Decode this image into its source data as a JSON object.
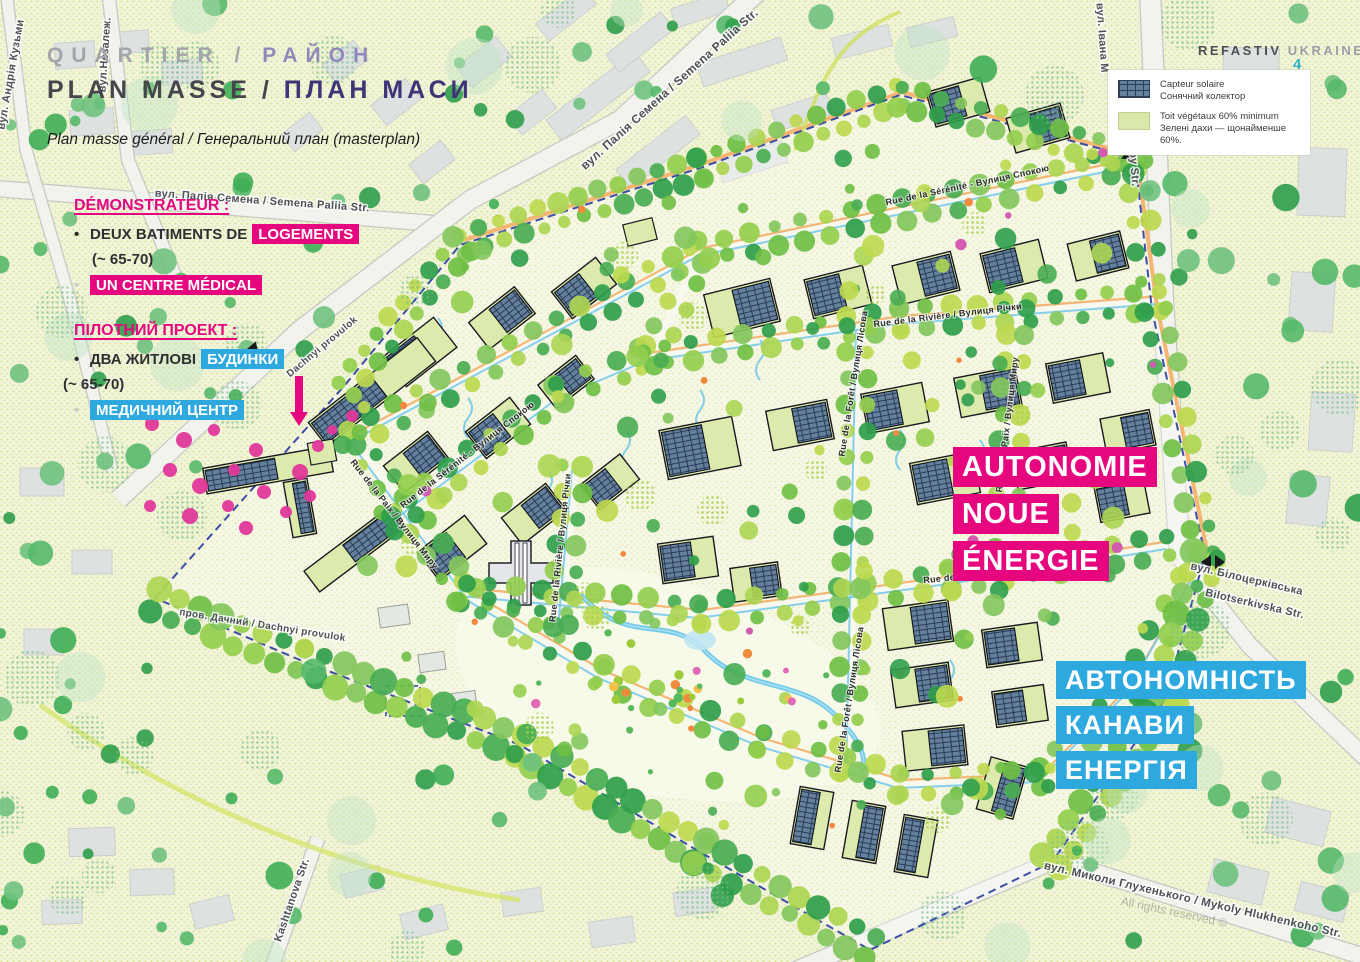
{
  "header": {
    "kicker_fr": "QUARTIER",
    "kicker_sep": " / ",
    "kicker_uk": "РАЙОН",
    "title_fr": "PLAN MASSE / ",
    "title_uk": "ПЛАН МАСИ",
    "subtitle": "Plan masse général / Генеральний план (masterplan)"
  },
  "brand": {
    "name": "REFASTIV ",
    "name2": "UKRAINE",
    "page": "4"
  },
  "legend": {
    "items": [
      {
        "icon": "solar-panel-swatch",
        "fr": "Capteur solaire",
        "uk": "Сонячний колектор"
      },
      {
        "icon": "green-roof-swatch",
        "fr": "Toit végétaux 60% minimum",
        "uk": "Зелені дахи — щонайменше 60%."
      }
    ]
  },
  "demonstrator": {
    "title": "DÉMONSTRATEUR :",
    "item1_pre": "DEUX BATIMENTS DE",
    "item1_hl": "LOGEMENTS",
    "item2": "(~ 65-70)",
    "item3_hl": "UN CENTRE MÉDICAL"
  },
  "pilot": {
    "title": "ПІЛОТНИЙ ПРОЕКТ :",
    "item1_pre": "ДВА ЖИТЛОВІ",
    "item1_hl": "БУДИНКИ",
    "item2": "(~ 65-70)",
    "item3_hl": "МЕДИЧНИЙ ЦЕНТР"
  },
  "callout_pink": {
    "l1": "AUTONOMIE",
    "l2": "NOUE",
    "l3": "ÉNERGIE"
  },
  "callout_blue": {
    "l1": "АВТОНОМНІСТЬ",
    "l2": "КАНАВИ",
    "l3": "ЕНЕРГІЯ"
  },
  "watermark": "All rights reserved ©",
  "colors": {
    "pink": "#e6077f",
    "blue": "#2ea9e0",
    "boundary": "#2b3f9e",
    "panel": "#64809f",
    "roof": "#dcebad",
    "accent_cyan": "#2ab3c9"
  },
  "map": {
    "boundary": [
      [
        155,
        598
      ],
      [
        345,
        385
      ],
      [
        460,
        245
      ],
      [
        700,
        168
      ],
      [
        900,
        95
      ],
      [
        1135,
        158
      ],
      [
        1152,
        310
      ],
      [
        1205,
        555
      ],
      [
        1165,
        700
      ],
      [
        1052,
        862
      ],
      [
        870,
        950
      ],
      [
        700,
        852
      ],
      [
        520,
        745
      ],
      [
        300,
        660
      ]
    ],
    "roads": [
      {
        "pts": [
          [
            -10,
            188
          ],
          [
            440,
            224
          ]
        ],
        "w": 15
      },
      {
        "pts": [
          [
            118,
            500
          ],
          [
            300,
            330
          ],
          [
            470,
            200
          ],
          [
            620,
            120
          ],
          [
            760,
            -10
          ]
        ],
        "w": 18
      },
      {
        "pts": [
          [
            108,
            -10
          ],
          [
            128,
            160
          ],
          [
            176,
            278
          ]
        ],
        "w": 12
      },
      {
        "pts": [
          [
            6,
            -10
          ],
          [
            26,
            150
          ],
          [
            70,
            300
          ],
          [
            112,
            470
          ]
        ],
        "w": 11
      },
      {
        "pts": [
          [
            1150,
            -10
          ],
          [
            1163,
            300
          ],
          [
            1180,
            558
          ]
        ],
        "w": 20
      },
      {
        "pts": [
          [
            1180,
            558
          ],
          [
            1250,
            646
          ],
          [
            1330,
            724
          ],
          [
            1370,
            762
          ]
        ],
        "w": 16
      },
      {
        "pts": [
          [
            772,
            980
          ],
          [
            1056,
            860
          ],
          [
            1368,
            958
          ]
        ],
        "w": 16
      },
      {
        "pts": [
          [
            318,
            838
          ],
          [
            268,
            978
          ]
        ],
        "w": 13
      }
    ],
    "avenues": [
      {
        "pts": [
          [
            352,
            438
          ],
          [
            700,
            252
          ],
          [
            1135,
            162
          ]
        ],
        "road": 1,
        "orange": 1,
        "blue": 1
      },
      {
        "pts": [
          [
            640,
            358
          ],
          [
            900,
            320
          ],
          [
            1160,
            300
          ]
        ],
        "road": 1,
        "orange": 1,
        "blue": 1
      },
      {
        "pts": [
          [
            462,
            592
          ],
          [
            700,
            614
          ],
          [
            950,
            580
          ],
          [
            1168,
            545
          ]
        ],
        "road": 1,
        "orange": 1,
        "blue": 1
      },
      {
        "pts": [
          [
            352,
            438
          ],
          [
            468,
            594
          ]
        ],
        "road": 1,
        "blue": 1
      },
      {
        "pts": [
          [
            388,
            522
          ],
          [
            560,
            394
          ],
          [
            650,
            356
          ]
        ],
        "road": 1,
        "blue": 1
      },
      {
        "pts": [
          [
            574,
            466
          ],
          [
            560,
            624
          ]
        ],
        "road": 1,
        "blue": 1
      },
      {
        "pts": [
          [
            1135,
            162
          ],
          [
            1155,
            310
          ],
          [
            1205,
            555
          ]
        ],
        "road": 1,
        "orange": 2
      },
      {
        "pts": [
          [
            462,
            592
          ],
          [
            600,
            674
          ],
          [
            760,
            742
          ],
          [
            900,
            784
          ],
          [
            1040,
            778
          ],
          [
            1128,
            690
          ],
          [
            1205,
            555
          ]
        ],
        "road": 1,
        "orange": 1,
        "blue": 1
      },
      {
        "pts": [
          [
            858,
            326
          ],
          [
            848,
            772
          ]
        ],
        "road": 1,
        "blue": 1
      },
      {
        "pts": [
          [
            700,
            254
          ],
          [
            652,
            356
          ]
        ],
        "road": 1
      },
      {
        "pts": [
          [
            462,
            244
          ],
          [
            700,
            168
          ],
          [
            900,
            96
          ],
          [
            1135,
            160
          ]
        ],
        "orange": 2,
        "dense": 1
      },
      {
        "pts": [
          [
            1016,
            308
          ],
          [
            1006,
            548
          ]
        ],
        "road": 1
      },
      {
        "pts": [
          [
            345,
            388
          ],
          [
            462,
            244
          ]
        ],
        "dense": 1
      },
      {
        "pts": [
          [
            155,
            600
          ],
          [
            300,
            660
          ],
          [
            520,
            745
          ],
          [
            700,
            852
          ],
          [
            870,
            948
          ]
        ],
        "dense": 1,
        "big": 1
      },
      {
        "pts": [
          [
            1205,
            555
          ],
          [
            1165,
            700
          ],
          [
            1052,
            862
          ]
        ],
        "dense": 1,
        "big": 1
      }
    ],
    "buildings": [
      [
        420,
        352,
        64,
        38,
        -38
      ],
      [
        502,
        318,
        58,
        34,
        -38
      ],
      [
        584,
        288,
        56,
        34,
        -38
      ],
      [
        416,
        462,
        56,
        34,
        -38
      ],
      [
        498,
        428,
        56,
        34,
        -38
      ],
      [
        566,
        382,
        48,
        30,
        -38
      ],
      [
        452,
        548,
        60,
        36,
        -38
      ],
      [
        534,
        514,
        56,
        34,
        -38
      ],
      [
        610,
        482,
        50,
        32,
        -38
      ],
      [
        742,
        308,
        68,
        44,
        -14
      ],
      [
        838,
        292,
        60,
        40,
        -14
      ],
      [
        926,
        278,
        60,
        40,
        -14
      ],
      [
        1014,
        266,
        60,
        40,
        -14
      ],
      [
        1098,
        256,
        54,
        38,
        -14
      ],
      [
        958,
        102,
        56,
        36,
        -16
      ],
      [
        1038,
        128,
        56,
        36,
        -16
      ],
      [
        700,
        448,
        74,
        50,
        -11
      ],
      [
        800,
        425,
        62,
        40,
        -11
      ],
      [
        895,
        408,
        62,
        40,
        -11
      ],
      [
        988,
        392,
        62,
        40,
        -11
      ],
      [
        1078,
        378,
        58,
        40,
        -11
      ],
      [
        1128,
        432,
        50,
        36,
        -11
      ],
      [
        945,
        478,
        64,
        42,
        -11
      ],
      [
        1042,
        466,
        56,
        38,
        -11
      ],
      [
        1122,
        500,
        50,
        36,
        -11
      ],
      [
        918,
        625,
        66,
        42,
        -8
      ],
      [
        1012,
        645,
        56,
        38,
        -8
      ],
      [
        922,
        685,
        58,
        38,
        -8
      ],
      [
        1020,
        706,
        52,
        36,
        -8
      ],
      [
        935,
        748,
        62,
        40,
        -6
      ],
      [
        812,
        818,
        34,
        58,
        10
      ],
      [
        864,
        832,
        34,
        58,
        10
      ],
      [
        916,
        846,
        34,
        58,
        10
      ],
      [
        1002,
        788,
        38,
        54,
        16
      ],
      [
        268,
        470,
        128,
        26,
        -10
      ],
      [
        355,
        549,
        108,
        26,
        -37
      ],
      [
        372,
        392,
        138,
        30,
        -38
      ],
      [
        300,
        508,
        24,
        56,
        -10
      ],
      [
        688,
        560,
        56,
        40,
        -8
      ],
      [
        756,
        582,
        48,
        34,
        -8
      ]
    ],
    "plain_buildings": [
      [
        640,
        232,
        30,
        22,
        -14
      ],
      [
        322,
        452,
        26,
        22,
        -10
      ]
    ],
    "sheds": [
      [
        394,
        616,
        30,
        20,
        -8
      ],
      [
        432,
        662,
        26,
        18,
        -8
      ],
      [
        464,
        700,
        24,
        16,
        -8
      ]
    ],
    "gray_buildings": [
      [
        75,
        55,
        40,
        26,
        -4
      ],
      [
        132,
        42,
        34,
        22,
        -4
      ],
      [
        182,
        72,
        40,
        24,
        -4
      ],
      [
        92,
        122,
        44,
        26,
        -4
      ],
      [
        152,
        142,
        40,
        24,
        -4
      ],
      [
        345,
        62,
        40,
        24,
        -38
      ],
      [
        396,
        102,
        44,
        26,
        -38
      ],
      [
        302,
        132,
        36,
        22,
        -38
      ],
      [
        432,
        162,
        40,
        24,
        -38
      ],
      [
        484,
        62,
        50,
        26,
        -38
      ],
      [
        532,
        112,
        44,
        24,
        -38
      ],
      [
        598,
        96,
        112,
        26,
        -38
      ],
      [
        658,
        152,
        88,
        24,
        -38
      ],
      [
        640,
        42,
        70,
        22,
        -38
      ],
      [
        742,
        62,
        88,
        24,
        -18
      ],
      [
        802,
        112,
        58,
        22,
        -18
      ],
      [
        752,
        162,
        68,
        22,
        -18
      ],
      [
        862,
        42,
        58,
        22,
        -14
      ],
      [
        932,
        32,
        48,
        20,
        -14
      ],
      [
        1250,
        92,
        56,
        88,
        2
      ],
      [
        1322,
        182,
        48,
        68,
        2
      ],
      [
        1312,
        302,
        44,
        58,
        4
      ],
      [
        1332,
        422,
        44,
        58,
        4
      ],
      [
        1308,
        500,
        40,
        50,
        6
      ],
      [
        1298,
        822,
        60,
        36,
        14
      ],
      [
        1238,
        882,
        56,
        34,
        14
      ],
      [
        1322,
        902,
        50,
        30,
        14
      ],
      [
        92,
        842,
        46,
        28,
        -2
      ],
      [
        152,
        882,
        44,
        26,
        -2
      ],
      [
        62,
        912,
        40,
        24,
        -2
      ],
      [
        212,
        912,
        40,
        26,
        -14
      ],
      [
        362,
        882,
        40,
        24,
        -14
      ],
      [
        424,
        922,
        44,
        26,
        -14
      ],
      [
        522,
        902,
        40,
        24,
        -8
      ],
      [
        612,
        932,
        44,
        26,
        -8
      ],
      [
        694,
        902,
        40,
        24,
        -8
      ],
      [
        42,
        482,
        44,
        28,
        0
      ],
      [
        92,
        562,
        40,
        24,
        0
      ],
      [
        44,
        642,
        40,
        26,
        0
      ],
      [
        566,
        14,
        60,
        22,
        -38
      ],
      [
        700,
        10,
        56,
        20,
        -18
      ]
    ],
    "pink_trees": [
      [
        152,
        424,
        7
      ],
      [
        184,
        440,
        8
      ],
      [
        214,
        430,
        6
      ],
      [
        170,
        470,
        7
      ],
      [
        200,
        486,
        8
      ],
      [
        234,
        470,
        6
      ],
      [
        256,
        450,
        7
      ],
      [
        150,
        506,
        6
      ],
      [
        190,
        516,
        8
      ],
      [
        228,
        506,
        6
      ],
      [
        264,
        492,
        7
      ],
      [
        286,
        512,
        6
      ],
      [
        300,
        472,
        8
      ],
      [
        318,
        446,
        6
      ],
      [
        310,
        496,
        6
      ],
      [
        246,
        528,
        7
      ],
      [
        332,
        430,
        5
      ],
      [
        352,
        416,
        6
      ]
    ],
    "squiggles": [
      [
        438,
        318
      ],
      [
        512,
        292
      ],
      [
        468,
        398
      ],
      [
        548,
        470
      ],
      [
        626,
        430
      ],
      [
        700,
        390
      ],
      [
        760,
        340
      ],
      [
        900,
        430
      ],
      [
        980,
        440
      ],
      [
        950,
        660
      ]
    ],
    "stream": "M582,596 C630,648 668,612 706,652 C744,692 800,678 836,716 C858,738 868,756 862,772",
    "curves": [
      {
        "d": "M40,705 C200,820 380,880 520,900",
        "c": "#d6e46a",
        "w": 5
      },
      {
        "d": "M795,150 C820,90 830,40 900,12",
        "c": "#cfe05c",
        "w": 4
      }
    ],
    "markers": [
      {
        "type": "tri",
        "x": 252,
        "y": 346,
        "r": 40
      },
      {
        "type": "dia",
        "x": 1213,
        "y": 562,
        "r": 0
      },
      {
        "type": "dia",
        "x": 1124,
        "y": 152,
        "r": 40
      }
    ],
    "cross": {
      "x": 521,
      "y": 573
    },
    "arrow": {
      "x": 299,
      "y1": 376,
      "y2": 412
    },
    "dashed_rect": [
      386,
      686,
      34,
      30
    ],
    "labels": [
      [
        "вул. Палія Семена / Semena Paliia Str.",
        262,
        204,
        4,
        11,
        "o"
      ],
      [
        "вул. Палія Семена / Semena Paliia Str.",
        672,
        92,
        -42,
        12,
        "o"
      ],
      [
        "вул.Незалеж.",
        108,
        55,
        -86,
        11,
        "o"
      ],
      [
        "вул. Андрія Кузьми",
        14,
        75,
        -80,
        11,
        "o"
      ],
      [
        "вул. Івана М",
        1099,
        38,
        86,
        11,
        "o"
      ],
      [
        "Mazepy Str.",
        1130,
        155,
        86,
        11,
        "o"
      ],
      [
        "вул. Білоцерківська",
        1246,
        582,
        13,
        11,
        "o"
      ],
      [
        "Bilotserkivska Str.",
        1254,
        607,
        13,
        11,
        "o"
      ],
      [
        "вул. Миколи Глухенького / Mykoly Hlukhenkoho Str.",
        1192,
        903,
        13,
        11.5,
        "o"
      ],
      [
        "Kashtanova Str.",
        295,
        901,
        -71,
        11,
        "o"
      ],
      [
        "пров. Дачний / Dachnyi provulok",
        262,
        628,
        9,
        10,
        "o"
      ],
      [
        "Dachnyi provulok",
        324,
        349,
        -40,
        10,
        "o"
      ],
      [
        "Rue de la Sérénité - Вулиця Спокою",
        968,
        188,
        -12,
        9,
        "i"
      ],
      [
        "Rue de la Sérénité - Вулиця Спокою",
        469,
        457,
        -38,
        9,
        "i"
      ],
      [
        "Rue de la Rivière / Вулиця Річки",
        948,
        318,
        -7,
        9,
        "i"
      ],
      [
        "Rue de la Rivière / Вулиця Річки",
        563,
        548,
        -84,
        9,
        "i"
      ],
      [
        "Rue de la Forêt / Вулиця Лісова",
        856,
        384,
        -81,
        9,
        "i"
      ],
      [
        "Rue de la Forêt / Вулиця Лісова",
        852,
        700,
        -81,
        9,
        "i"
      ],
      [
        "Rue de la Paix / Вулиця Миру",
        392,
        516,
        52,
        9,
        "i"
      ],
      [
        "Rue de la Paix / Вулиця Миру",
        1010,
        425,
        -83,
        9,
        "i"
      ],
      [
        "Rue de l'Avenir / Вулиця Майбутнього",
        1012,
        574,
        -6,
        9,
        "i"
      ]
    ]
  }
}
